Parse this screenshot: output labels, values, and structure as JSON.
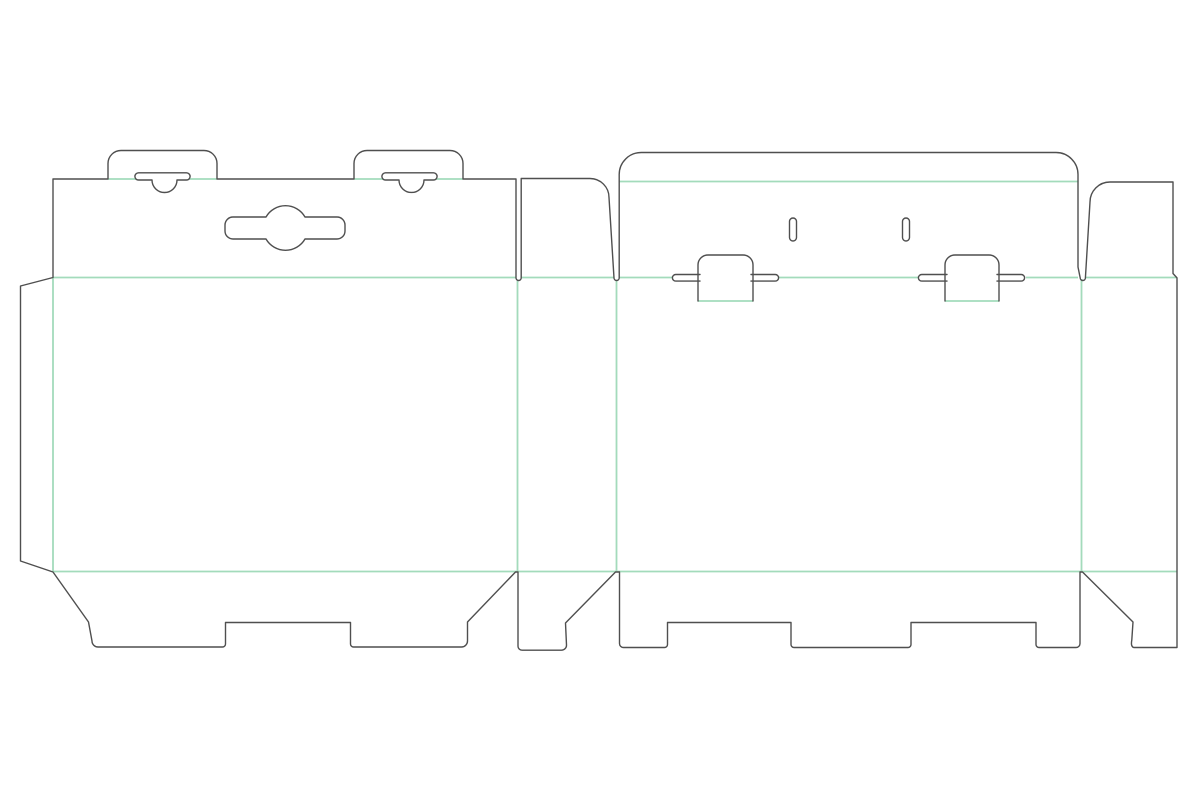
{
  "canvas": {
    "width": 1200,
    "height": 800,
    "background": "#ffffff"
  },
  "style": {
    "cut_color": "#4f4f4f",
    "cut_width": 1.4,
    "crease_color": "#a3dbbb",
    "crease_width": 1.8
  },
  "dieline": {
    "cut_paths": [
      {
        "name": "blank-outline",
        "d": "M 53 277.5 L 53 179 L 108 179 L 108 163.5 A 13 13 0 0 1 121 150.5 L 204 150.5 A 13 13 0 0 1 217 163.5 L 217 179 L 354 179 L 354 163.5 A 13 13 0 0 1 367 150.5 L 450 150.5 A 13 13 0 0 1 463 163.5 L 463 179 L 516 179 L 516 277.9 A 2.6 2.6 0 0 0 521.2 277.9 L 521.2 178.5 L 590 178.5 A 19 19 0 0 1 609 197.5 L 614 277.9 A 2.6 2.6 0 0 0 619.2 277.9 L 619.2 174.5 A 22 22 0 0 1 641.2 152.5 L 1056 152.5 A 22 22 0 0 1 1078 174.5 L 1078 267 L 1080.2 277.9 A 2.6 2.6 0 0 0 1085.4 277.9 L 1090 202 A 20 20 0 0 1 1110 182 L 1173 182 L 1173 273.5 L 1177 277.9 L 1177 647.5 L 1134 647.5 Q 1130.5 647 1131.8 640 L 1133 622 L 1082.5 572 L 1080 572 L 1080 643.5 A 4 4 0 0 1 1076 647.5 L 1039 647.5 A 3 3 0 0 1 1036 644.5 L 1036 622.5 L 911 622.5 L 911 644.5 A 3 3 0 0 1 908 647.5 L 794 647.5 A 3 3 0 0 1 791 644.5 L 791 622.5 L 667.5 622.5 L 667.5 644.5 A 3 3 0 0 1 664.5 647.5 L 623.5 647.5 A 4 4 0 0 1 619.5 643.5 L 619.5 572 L 615.5 572 L 565.5 623 L 566.5 645 A 5 5 0 0 1 561.5 650.2 L 522 650.2 A 4 4 0 0 1 518 646.2 L 518 572 L 515.5 572 L 467.5 622 L 467.5 641 A 6 6 0 0 1 461.5 647 L 353.5 647 A 3 3 0 0 1 350.5 644 L 350.5 622.5 L 225.5 622.5 L 225.5 644 A 3 3 0 0 1 222.5 647 L 98 647 A 6 6 0 0 1 92 641 L 88.5 622 L 53 572 L 20.5 561 L 20.5 286 Z"
      },
      {
        "name": "hang-tab-slit-left",
        "d": "M 138.5 172.8 L 186.5 172.8 A 3.6 3.6 0 0 1 186.5 180 L 177 180 A 12.5 12.5 0 0 1 152 180 L 138.5 180 A 3.6 3.6 0 0 1 138.5 172.8 Z"
      },
      {
        "name": "hang-tab-slit-right",
        "d": "M 385.5 172.8 L 433.5 172.8 A 3.6 3.6 0 0 1 433.5 180 L 424 180 A 12.5 12.5 0 0 1 399 180 L 385.5 180 A 3.6 3.6 0 0 1 385.5 172.8 Z"
      },
      {
        "name": "euro-hanger-slot",
        "d": "M 233 217 L 266 217 A 22.5 22.5 0 0 1 305 217 L 337 217 A 8 8 0 0 1 345 225 L 345 231 A 8 8 0 0 1 337 239 L 305 239 A 22.5 22.5 0 0 1 266 239 L 233 239 A 8 8 0 0 1 225 231 L 225 225 A 8 8 0 0 1 233 217 Z"
      },
      {
        "name": "lid-vent-slit-left",
        "d": "M 789.5 221.5 A 3.5 3.5 0 0 1 796.5 221.5 L 796.5 237.5 A 3.5 3.5 0 0 1 789.5 237.5 Z"
      },
      {
        "name": "lid-vent-slit-right",
        "d": "M 902.5 221.5 A 3.5 3.5 0 0 1 909.5 221.5 L 909.5 237.5 A 3.5 3.5 0 0 1 902.5 237.5 Z"
      },
      {
        "name": "lock-tab-left",
        "d": "M 698 301 L 698 265 A 10 10 0 0 1 708 255 L 743 255 A 10 10 0 0 1 753 265 L 753 301"
      },
      {
        "name": "lock-tab-left-wing-left",
        "d": "M 700 274.5 L 675.7 274.5 A 3.3 3.3 0 0 0 675.7 281.1 L 700 281.1"
      },
      {
        "name": "lock-tab-left-wing-right",
        "d": "M 751 274.5 L 775.3 274.5 A 3.3 3.3 0 0 1 775.3 281.1 L 751 281.1"
      },
      {
        "name": "lock-tab-right",
        "d": "M 945 301 L 945 265 A 10 10 0 0 1 955 255 L 989 255 A 10 10 0 0 1 999 265 L 999 301"
      },
      {
        "name": "lock-tab-right-wing-left",
        "d": "M 947 274.5 L 921.7 274.5 A 3.3 3.3 0 0 0 921.7 281.1 L 947 281.1"
      },
      {
        "name": "lock-tab-right-wing-right",
        "d": "M 997 274.5 L 1021.3 274.5 A 3.3 3.3 0 0 1 1021.3 281.1 L 997 281.1"
      }
    ],
    "crease_lines": [
      {
        "name": "hang-tab-left-fold-a",
        "x1": 108,
        "y1": 179,
        "x2": 136,
        "y2": 179
      },
      {
        "name": "hang-tab-left-fold-b",
        "x1": 189,
        "y1": 179,
        "x2": 217,
        "y2": 179
      },
      {
        "name": "hang-tab-right-fold-a",
        "x1": 354,
        "y1": 179,
        "x2": 383,
        "y2": 179
      },
      {
        "name": "hang-tab-right-fold-b",
        "x1": 436,
        "y1": 179,
        "x2": 463,
        "y2": 179
      },
      {
        "name": "front-top-fold",
        "x1": 53,
        "y1": 277.5,
        "x2": 516,
        "y2": 277.5
      },
      {
        "name": "dust-flap-left-fold",
        "x1": 521.2,
        "y1": 277.5,
        "x2": 614,
        "y2": 277.5
      },
      {
        "name": "lid-fold-a",
        "x1": 619.5,
        "y1": 277.5,
        "x2": 672,
        "y2": 277.5
      },
      {
        "name": "lid-fold-b",
        "x1": 779,
        "y1": 277.5,
        "x2": 918,
        "y2": 277.5
      },
      {
        "name": "lid-fold-c",
        "x1": 1026,
        "y1": 277.5,
        "x2": 1078,
        "y2": 277.5
      },
      {
        "name": "dust-flap-right-fold",
        "x1": 1085.4,
        "y1": 277.5,
        "x2": 1177,
        "y2": 277.5
      },
      {
        "name": "lid-tuck-fold",
        "x1": 619.5,
        "y1": 181.5,
        "x2": 1078,
        "y2": 181.5
      },
      {
        "name": "lock-tab-left-fold",
        "x1": 698,
        "y1": 301,
        "x2": 753,
        "y2": 301
      },
      {
        "name": "lock-tab-right-fold",
        "x1": 945,
        "y1": 301,
        "x2": 999,
        "y2": 301
      },
      {
        "name": "bottom-fold",
        "x1": 53,
        "y1": 571.5,
        "x2": 1177,
        "y2": 571.5
      },
      {
        "name": "glue-flap-fold",
        "x1": 53,
        "y1": 277.5,
        "x2": 53,
        "y2": 571.5
      },
      {
        "name": "panel-fold-1",
        "x1": 517.5,
        "y1": 281,
        "x2": 517.5,
        "y2": 571.5
      },
      {
        "name": "panel-fold-2",
        "x1": 616.5,
        "y1": 281,
        "x2": 616.5,
        "y2": 571.5
      },
      {
        "name": "panel-fold-3",
        "x1": 1081.5,
        "y1": 279,
        "x2": 1081.5,
        "y2": 571.5
      }
    ]
  }
}
